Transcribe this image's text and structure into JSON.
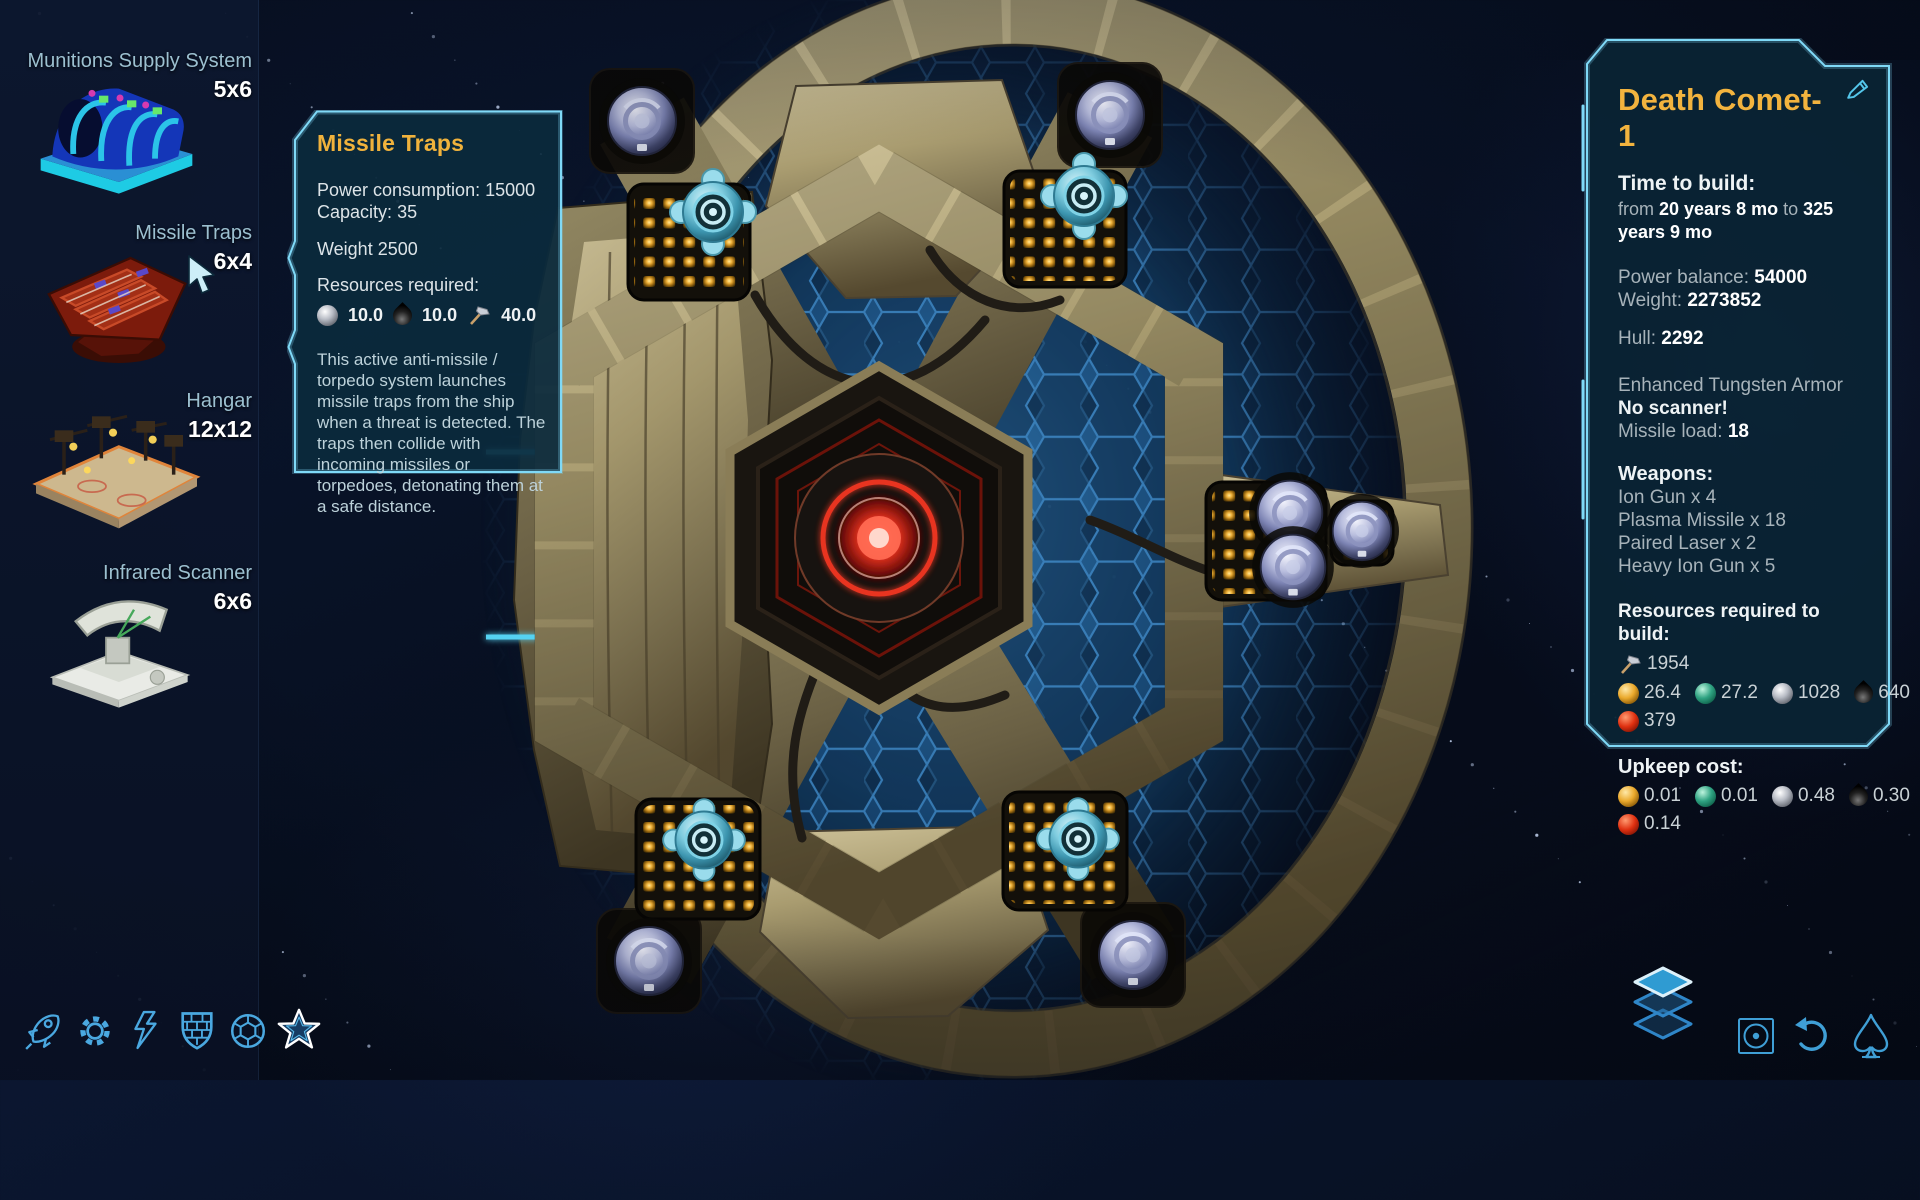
{
  "sidebar": {
    "items": [
      {
        "name": "Munitions Supply System",
        "size": "5x6",
        "icon": "munitions-supply-thumbnail"
      },
      {
        "name": "Missile Traps",
        "size": "6x4",
        "icon": "missile-traps-thumbnail"
      },
      {
        "name": "Hangar",
        "size": "12x12",
        "icon": "hangar-thumbnail"
      },
      {
        "name": "Infrared Scanner",
        "size": "6x6",
        "icon": "infrared-scanner-thumbnail"
      }
    ],
    "category_bar": [
      "rocket-icon",
      "gear-icon",
      "lightning-icon",
      "brick-shield-icon",
      "hex-sphere-icon",
      "star-icon"
    ],
    "active_category": "star-icon"
  },
  "tooltip": {
    "title": "Missile Traps",
    "power_label": "Power consumption:",
    "power_value": "15000",
    "capacity_label": "Capacity:",
    "capacity_value": "35",
    "weight_label": "Weight",
    "weight_value": "2500",
    "resources_label": "Resources required:",
    "resources": [
      {
        "icon": "silver-ore-icon",
        "value": "10.0"
      },
      {
        "icon": "oil-drop-icon",
        "value": "10.0"
      },
      {
        "icon": "build-hammer-icon",
        "value": "40.0"
      }
    ],
    "description": "This active anti-missile / torpedo system launches missile traps from the ship when a threat is detected. The traps then collide with incoming missiles or torpedoes, detonating them at a safe distance."
  },
  "ship_panel": {
    "title": "Death Comet-1",
    "edit_icon": "pencil-icon",
    "time_label": "Time to build:",
    "time_from_label": "from",
    "time_from": "20 years 8 mo",
    "time_to_label": "to",
    "time_to": "325 years 9 mo",
    "power_balance_label": "Power balance:",
    "power_balance": "54000",
    "weight_label": "Weight:",
    "weight": "2273852",
    "hull_label": "Hull:",
    "hull": "2292",
    "armor": "Enhanced Tungsten Armor",
    "scanner": "No scanner!",
    "missile_load_label": "Missile load:",
    "missile_load": "18",
    "weapons_label": "Weapons:",
    "weapons": [
      "Ion Gun x 4",
      "Plasma Missile x 18",
      "Paired Laser x 2",
      "Heavy Ion Gun x 5"
    ],
    "build_label": "Resources required to build:",
    "build_hammer": "1954",
    "build_gold": "26.4",
    "build_gem": "27.2",
    "build_silver": "1028",
    "build_oil": "640",
    "build_red": "379",
    "upkeep_label": "Upkeep cost:",
    "upkeep_gold": "0.01",
    "upkeep_gem": "0.01",
    "upkeep_silver": "0.48",
    "upkeep_oil": "0.30",
    "upkeep_red": "0.14"
  },
  "action_bar": [
    "layers-icon",
    "center-view-icon",
    "undo-icon",
    "spade-ship-icon"
  ],
  "colors": {
    "accent": "#7fd9f7",
    "title_gold": "#f2b33e",
    "panel_bg": "#0b2a3c"
  }
}
